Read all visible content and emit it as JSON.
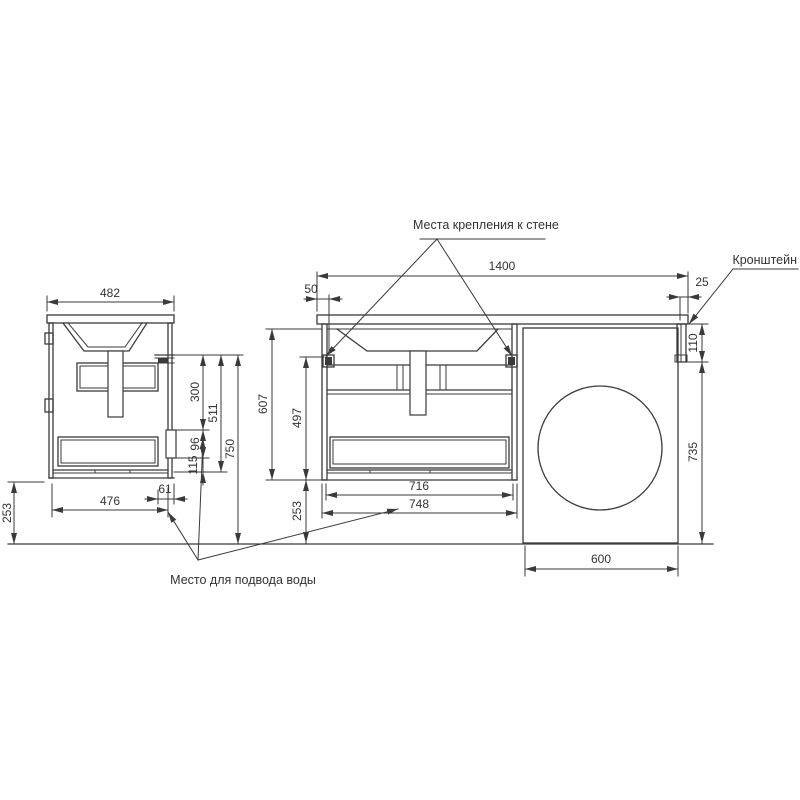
{
  "annotations": {
    "wall_mount_label": "Места крепления к стене",
    "bracket_label": "Кронштейн",
    "water_supply_label": "Место для подвода воды"
  },
  "dimensions": {
    "side_view": {
      "top_depth": "482",
      "mount_to_cutout": "300",
      "mount_to_drawer_bottom": "511",
      "mount_height": "750",
      "cutout_height": "96",
      "cutout_to_bottom": "115",
      "back_clearance": "61",
      "bottom_depth": "476",
      "floor_gap": "253"
    },
    "front_view": {
      "total_width": "1400",
      "left_overhang": "50",
      "right_overhang": "25",
      "bracket_height": "110",
      "washer_height": "735",
      "cabinet_height": "607",
      "mount_to_bottom": "497",
      "floor_gap": "253",
      "mount_span": "716",
      "cabinet_width": "748",
      "washer_width": "600"
    }
  },
  "colors": {
    "line": "#3a3a3a",
    "text": "#333333",
    "background": "#ffffff"
  }
}
